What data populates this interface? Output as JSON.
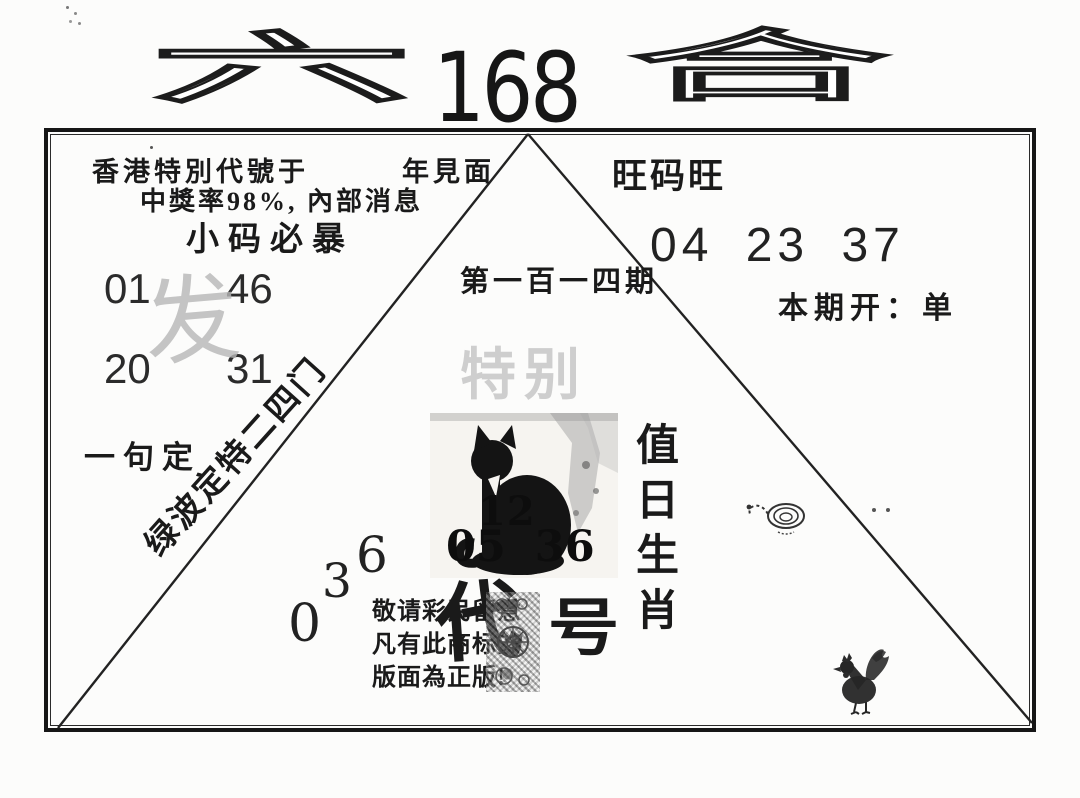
{
  "page": {
    "background": "#fcfcfb",
    "ink": "#1a1a1a",
    "watermark_gray": "#c7c7c7"
  },
  "logo": {
    "left_char": "六",
    "number": "168",
    "right_char": "合"
  },
  "header": {
    "line1": "香港特別代號于　　　年見面",
    "line2": "中獎率98%, 內部消息",
    "line3": "小码必暴"
  },
  "right_block": {
    "title": "旺码旺",
    "numbers": "04 23 37",
    "result": "本期开：单",
    "zodiac": [
      "值",
      "日",
      "生",
      "肖"
    ]
  },
  "center": {
    "period": "第一百一四期",
    "special_watermark": "特别",
    "cat_numbers_top": "12",
    "cat_numbers_bottom": "05 36",
    "notice": [
      "敬请彩民留意",
      "凡有此商标的",
      "版面為正版!"
    ],
    "code_left": "代",
    "code_right": "号"
  },
  "left_block": {
    "numbers": [
      "01",
      "46",
      "20",
      "31"
    ],
    "watermark": "发",
    "phrase": "一句定",
    "diagonal_text": "绿波定特二四门",
    "diagonal_digits": [
      "0",
      "3",
      "6"
    ]
  },
  "icons": {
    "cat": "black-cat-picture",
    "snake": "coiled-snake-sketch",
    "rooster": "rooster-sketch",
    "stamp": "ornate-seal-stamp",
    "triangle": "triangle-diagram"
  }
}
